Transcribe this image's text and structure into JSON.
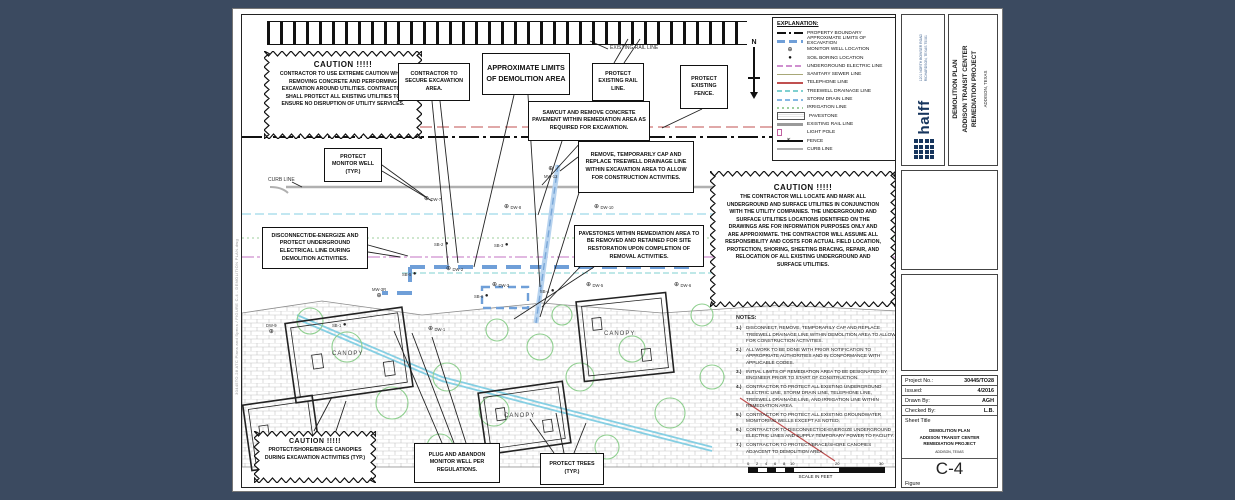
{
  "colors": {
    "background": "#3b4a60",
    "sheet": "#ffffff",
    "line_black": "#1a1a1a",
    "rail_red": "#c05050",
    "electric_pink": "#cf8fcf",
    "storm_cyan": "#86cfe3",
    "treewell_cyan": "#7fd0d0",
    "irrigation_green": "#9ccf9c",
    "excavation_blue": "#6f9fd8",
    "tree_green": "#8fcf8f",
    "curb_gray": "#b0b0b0",
    "halff_navy": "#16355d"
  },
  "sheet": {
    "file_path": "30445TO.28 ATC Plans and Specs / FIGURE C-4 - DEMOLITION PLAN.dwg"
  },
  "plan": {
    "labels": {
      "existing_rail_line": "EXISTING RAIL LINE",
      "curb_line": "CURB LINE",
      "canopy": "CANOPY",
      "north": "N"
    },
    "wells": [
      {
        "sym": "⊕",
        "label": "MW-12"
      },
      {
        "sym": "⊕",
        "label": "DW-7"
      },
      {
        "sym": "⊕",
        "label": "DW-8"
      },
      {
        "sym": "⊕",
        "label": "DW-10"
      },
      {
        "sym": "●",
        "label": "SB-2"
      },
      {
        "sym": "●",
        "label": "SB-3"
      },
      {
        "sym": "●",
        "label": "SB-5"
      },
      {
        "sym": "⊕",
        "label": "DW-2"
      },
      {
        "sym": "⊕",
        "label": "DW-3"
      },
      {
        "sym": "●",
        "label": "SB-6"
      },
      {
        "sym": "●",
        "label": "SB-4"
      },
      {
        "sym": "⊕",
        "label": "DW-5"
      },
      {
        "sym": "⊕",
        "label": "DW-6"
      },
      {
        "sym": "⊕",
        "label": "DW-4"
      },
      {
        "sym": "⊕",
        "label": "MW-3R"
      },
      {
        "sym": "●",
        "label": "SB-1"
      },
      {
        "sym": "⊕",
        "label": "DW-1"
      },
      {
        "sym": "⊕",
        "label": "DW-9"
      }
    ]
  },
  "legend": {
    "title": "EXPLANATION:",
    "items": [
      {
        "label": "PROPERTY BOUNDARY"
      },
      {
        "label": "APPROXIMATE LIMITS OF EXCAVATION"
      },
      {
        "label": "MONITOR WELL LOCATION"
      },
      {
        "label": "SOIL BORING LOCATION"
      },
      {
        "label": "UNDERGROUND ELECTRIC LINE"
      },
      {
        "label": "SANITARY SEWER LINE"
      },
      {
        "label": "TELEPHONE LINE"
      },
      {
        "label": "TREEWELL DRAINAGE LINE"
      },
      {
        "label": "STORM DRAIN LINE"
      },
      {
        "label": "IRRIGATION LINE"
      },
      {
        "label": "PAVESTONE"
      },
      {
        "label": "EXISTING RAIL LINE"
      },
      {
        "label": "LIGHT POLE"
      },
      {
        "label": "FENCE"
      },
      {
        "label": "CURB LINE"
      }
    ]
  },
  "cautions": {
    "top_left": {
      "title": "CAUTION  !!!!!",
      "body": "CONTRACTOR TO USE EXTREME CAUTION WHEN REMOVING CONCRETE AND PERFORMING EXCAVATION AROUND UTILITIES. CONTRACTOR SHALL PROTECT ALL EXISTING UTILITIES TO ENSURE NO DISRUPTION OF UTILITY SERVICES."
    },
    "right": {
      "title": "CAUTION  !!!!!",
      "body": "THE CONTRACTOR WILL LOCATE AND MARK ALL UNDERGROUND AND SURFACE UTILITIES IN CONJUNCTION WITH THE UTILITY COMPANIES. THE UNDERGROUND AND SURFACE UTILITIES LOCATIONS IDENTIFIED ON THE DRAWINGS ARE FOR INFORMATION PURPOSES ONLY AND ARE APPROXIMATE.  THE CONTRACTOR WILL ASSUME ALL RESPONSIBILITY AND COSTS FOR ACTUAL FIELD LOCATION, PROTECTION, SHORING, SHEETING BRACING, REPAIR, AND RELOCATION OF ALL EXISTING UNDERGROUND AND SURFACE UTILITIES."
    },
    "bottom_left": {
      "title": "CAUTION  !!!!!",
      "body": "PROTECT/SHORE/BRACE CANOPIES DURING EXCAVATION ACTIVITIES (TYP.)"
    }
  },
  "callouts": {
    "secure": "CONTRACTOR TO SECURE EXCAVATION AREA.",
    "demo_limits": "APPROXIMATE LIMITS OF DEMOLITION AREA",
    "protect_rail": "PROTECT EXISTING RAIL LINE.",
    "protect_fence": "PROTECT EXISTING FENCE.",
    "sawcut": "SAWCUT AND REMOVE CONCRETE PAVEMENT WITHIN REMEDIATION AREA AS REQUIRED FOR EXCAVATION.",
    "treewell": "REMOVE, TEMPORARILY CAP AND REPLACE TREEWELL DRAINAGE LINE WITHIN EXCAVATION AREA TO ALLOW FOR CONSTRUCTION ACTIVITIES.",
    "monitor_well": "PROTECT MONITOR WELL (TYP.)",
    "disconnect": "DISCONNECT/DE-ENERGIZE AND PROTECT UNDERGROUND ELECTRICAL LINE DURING DEMOLITION ACTIVITIES.",
    "pavestones": "PAVESTONES WITHIN REMEDIATION AREA TO BE REMOVED AND RETAINED FOR SITE RESTORATION UPON COMPLETION OF REMOVAL ACTIVITIES.",
    "plug_abandon": "PLUG AND ABANDON MONITOR WELL PER REGULATIONS.",
    "protect_trees": "PROTECT TREES (TYP.)"
  },
  "notes": {
    "title": "NOTES:",
    "items": [
      {
        "num": "1.)",
        "text": "DISCONNECT, REMOVE, TEMPORARILY CAP AND REPLACE TREEWELL DRAINAGE LINE WITHIN DEMOLITION AREA TO ALLOW FOR CONSTRUCTION ACTIVITIES."
      },
      {
        "num": "2.)",
        "text": "ALL WORK TO BE DONE WITH PRIOR NOTIFICATION TO APPROPRIATE AUTHORITIES AND IN CONFORMANCE WITH APPLICABLE CODES."
      },
      {
        "num": "3.)",
        "text": "INITIAL LIMITS OF REMEDIATION AREA TO BE DESIGNATED BY ENGINEER PRIOR TO START OF CONSTRUCTION."
      },
      {
        "num": "4.)",
        "text": "CONTRACTOR TO PROTECT ALL EXISTING UNDERGROUND ELECTRIC LINE, STORM DRAIN LINE, TELEPHONE LINE, TREEWELL DRAINAGE LINE, AND IRRIGATION LINE WITHIN REMEDIATION AREA."
      },
      {
        "num": "5.)",
        "text": "CONTRACTOR TO PROTECT ALL EXISTING GROUNDWATER MONITORING WELLS EXCEPT AS NOTED."
      },
      {
        "num": "6.)",
        "text": "CONTRACTOR TO DISCONNECT/DE-ENERGIZE UNDERGROUND ELECTRIC LINES AND SUPPLY TEMPORARY POWER TO FACILITY."
      },
      {
        "num": "7.)",
        "text": "CONTRACTOR TO PROTECT/BRACE/SHORE CANOPIES ADJACENT TO DEMOLITION AREA."
      }
    ]
  },
  "scale": {
    "labels": [
      "0",
      "2",
      "4",
      "6",
      "8",
      "10",
      "20",
      "30"
    ],
    "caption": "SCALE IN FEET"
  },
  "titleblock": {
    "company": "halff",
    "address": [
      "1201 NORTH BOWSER ROAD",
      "RICHARDSON, TEXAS 75081"
    ],
    "project_title": [
      "DEMOLITION PLAN",
      "ADDISON TRANSIT CENTER",
      "REMEDIATION PROJECT"
    ],
    "location": "ADDISON, TEXAS",
    "info": {
      "project_no_label": "Project No.:",
      "project_no": "30445/TO28",
      "issued_label": "Issued:",
      "issued": "4/2016",
      "drawn_label": "Drawn By:",
      "drawn": "AGH",
      "checked_label": "Checked By:",
      "checked": "L.B.",
      "sheet_title_label": "Sheet Title",
      "sheet_no": "C-4",
      "figure_label": "Figure"
    }
  }
}
